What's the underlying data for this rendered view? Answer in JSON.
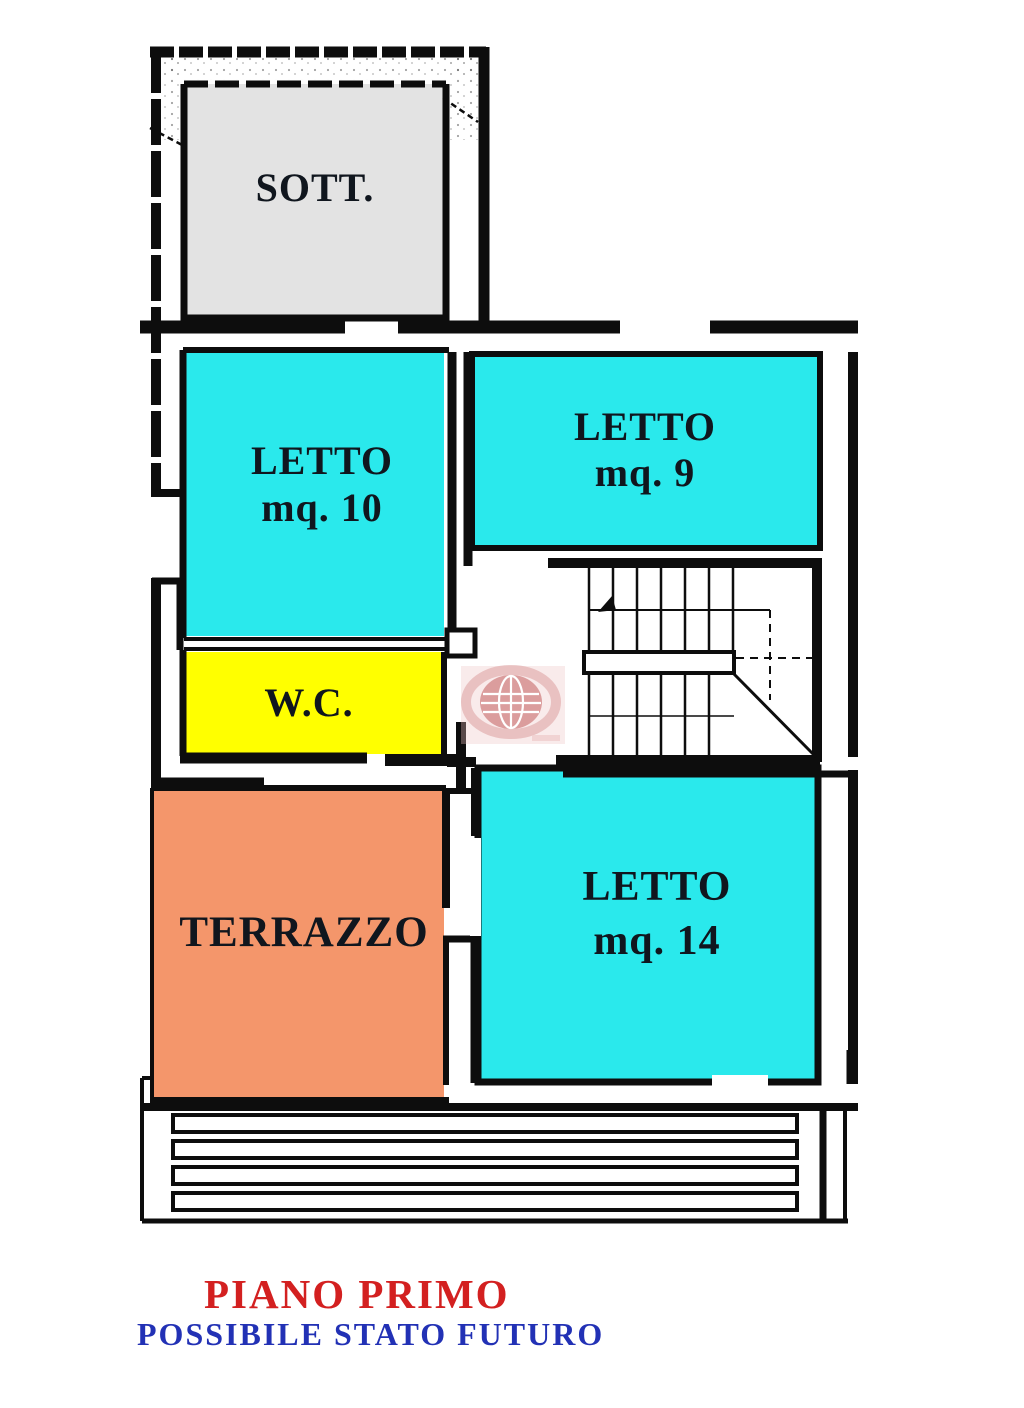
{
  "plan": {
    "rooms": {
      "sott": {
        "label": "SOTT.",
        "color": "#e3e3e3"
      },
      "letto10": {
        "label": "LETTO",
        "area": "mq. 10",
        "color": "#2ae9ec"
      },
      "letto9": {
        "label": "LETTO",
        "area": "mq. 9",
        "color": "#2ae9ec"
      },
      "wc": {
        "label": "W.C.",
        "color": "#ffff00"
      },
      "terrazzo": {
        "label": "TERRAZZO",
        "color": "#f4966b"
      },
      "letto14": {
        "label": "LETTO",
        "area": "mq. 14",
        "color": "#2ae9ec"
      }
    },
    "wall_color": "#0d0d0d",
    "label_color": "#10161e"
  },
  "footer": {
    "title": "PIANO PRIMO",
    "title_color": "#d32020",
    "subtitle": "POSSIBILE STATO FUTURO",
    "subtitle_color": "#2231b5"
  },
  "watermark": {
    "color": "#b02828",
    "background": "#eec3c3"
  }
}
